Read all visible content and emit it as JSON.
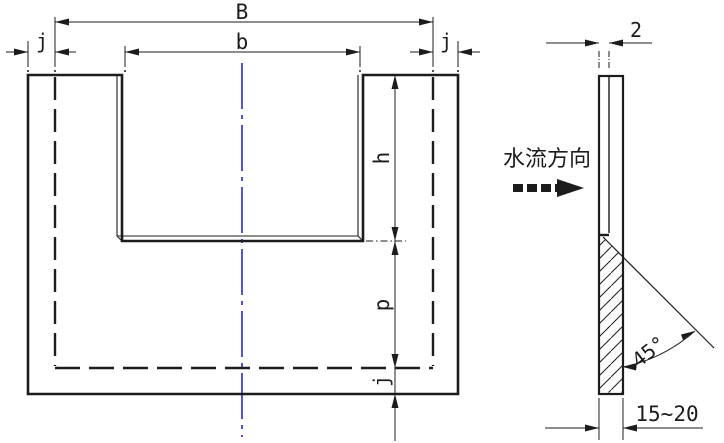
{
  "drawing": {
    "title_semantic": "rectangular notch weir plate drawing",
    "front_view": {
      "dim_total_width": "B",
      "dim_notch_width": "b",
      "dim_margin_left": "j",
      "dim_margin_right": "j",
      "dim_notch_depth": "h",
      "dim_crest_height": "p",
      "dim_margin_bottom": "j"
    },
    "side_view": {
      "dim_crest_thickness": "2",
      "flow_direction_label": "水流方向",
      "dim_bevel_angle": "45°",
      "dim_plate_thickness": "15~20"
    },
    "colors": {
      "line": "#1c1c1c",
      "centerline": "#0a0ac8",
      "background": "#ffffff"
    }
  }
}
